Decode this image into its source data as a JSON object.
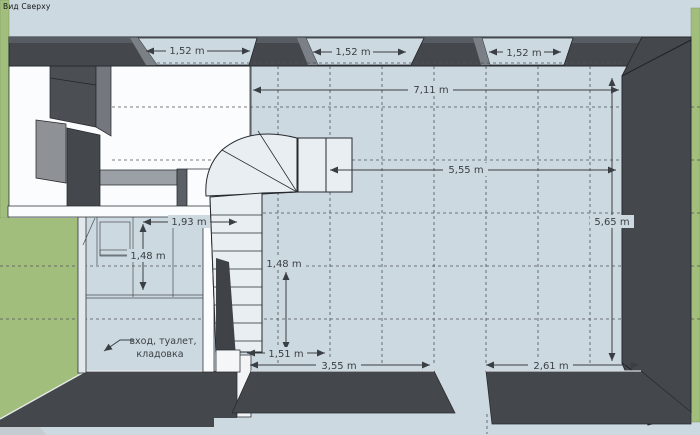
{
  "view_label": "Вид Сверху",
  "dimensions": {
    "window_1": "1,52 m",
    "window_2": "1,52 m",
    "window_3": "1,52 m",
    "total_width": "7,11 m",
    "main_width": "5,55 m",
    "main_depth": "5,65 m",
    "hall_width": "1,93 m",
    "hall_depth": "1,48 m",
    "stair_run": "1,48 m",
    "stair_width": "1,51 m",
    "bottom_left_width": "3,55 m",
    "bottom_right_width": "2,61 m"
  },
  "annotation": {
    "line1": "вход, туалет,",
    "line2": "кладовка"
  },
  "colors": {
    "canvas": "#cdd9e0",
    "ground_green": "#a2be7d",
    "wall_dark": "#44484d",
    "wall_light_face": "#6d7278",
    "surface_white": "#fbfcfd",
    "step_fill": "#e8eef2",
    "dimension": "#3a3f44"
  }
}
